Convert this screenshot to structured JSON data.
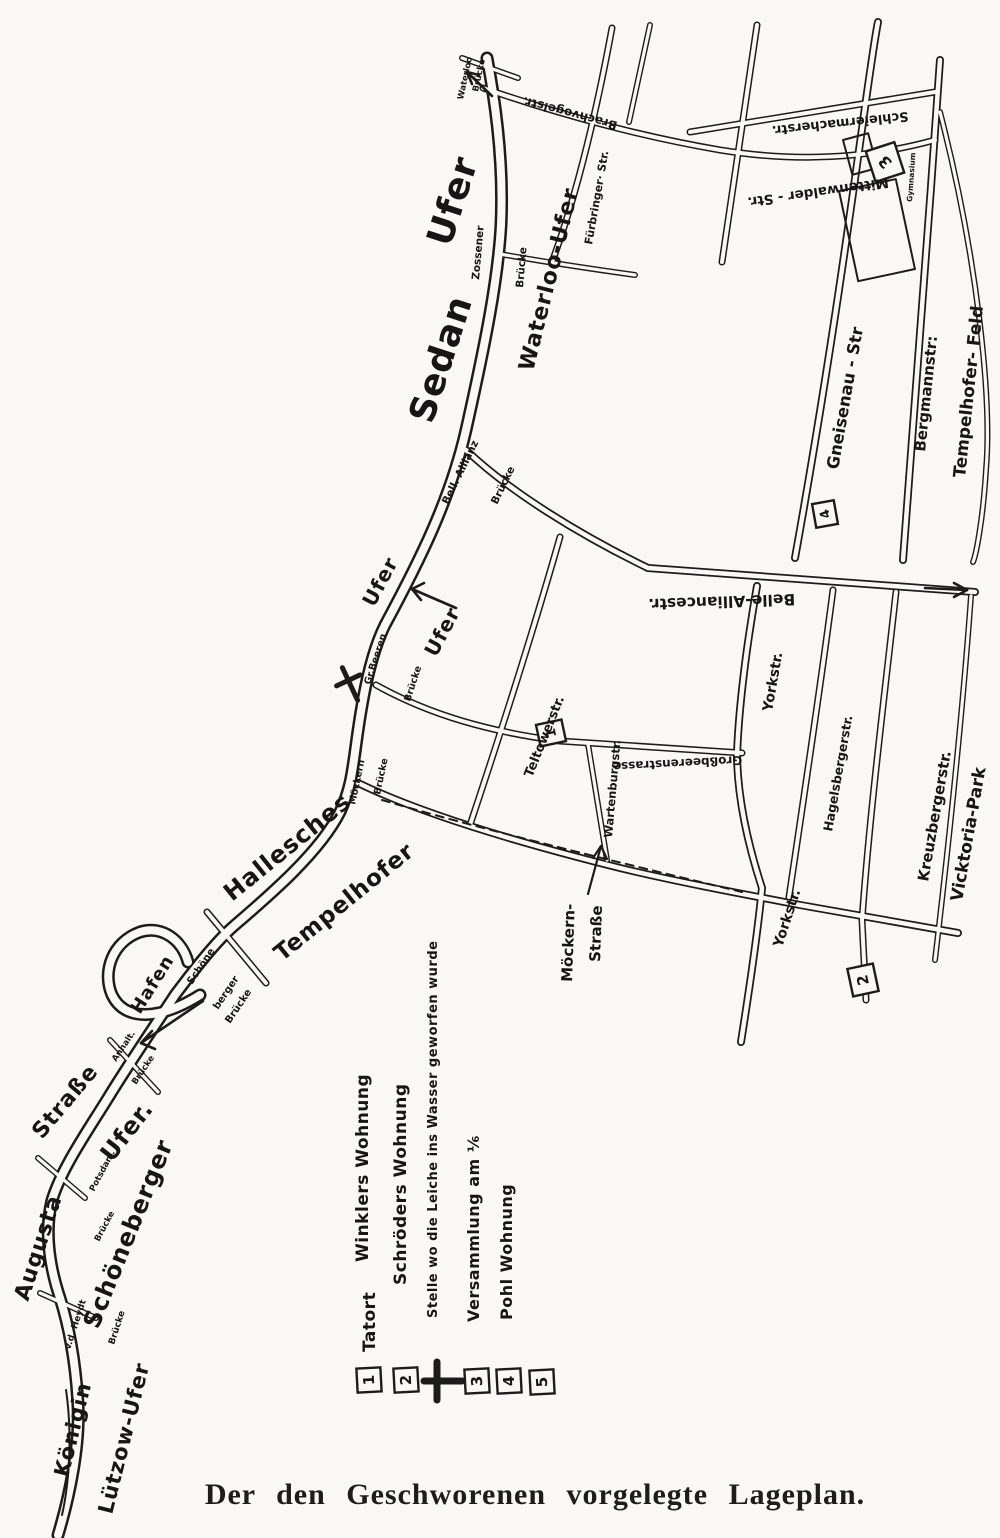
{
  "caption": {
    "text": "Der den Geschworenen vorgelegte Lageplan."
  },
  "legend": {
    "items": [
      {
        "symbol": "numbered-box",
        "number": "1",
        "label": "Tatort Winklers Wohnung",
        "label_line1": "Tatort",
        "label_line2": "Winklers Wohnung"
      },
      {
        "symbol": "numbered-box",
        "number": "2",
        "label": "Schröders Wohnung"
      },
      {
        "symbol": "cross",
        "label": "Stelle wo die Leiche ins Wasser geworfen wurde"
      },
      {
        "symbol": "numbered-box",
        "number": "3",
        "label": "Versammlung am ⅙"
      },
      {
        "symbol": "numbered-box",
        "number": "4",
        "label": "Pohl Wohnung"
      },
      {
        "symbol": "numbered-box",
        "number": "5",
        "label": ""
      }
    ]
  },
  "map": {
    "markers": {
      "m1": "1",
      "m2": "2",
      "m3": "3",
      "m4": "4"
    },
    "labels": {
      "sedan": "Sedan",
      "ufer_top": "Ufer",
      "waterloo_ufer": "Waterloo-Ufer",
      "ufer_bend_left": "Ufer",
      "ufer_bend_right": "Ufer",
      "hallesches": "Hallesches",
      "tempelhofer": "Tempelhofer",
      "hafen": "Hafen",
      "schoeneberger_big": "Schöneberger",
      "schoeneberger_ufer_word": "Ufer.",
      "strasse_big": "Straße",
      "augusta": "Augusta",
      "koenigin": "Königin",
      "luetzow_ufer": "Lützow-Ufer",
      "waterloo_br_1": "Waterloo",
      "waterloo_br_2": "Brücke",
      "zossener": "Zossener",
      "zossener_br": "Brücke",
      "brachvogelstr": "Brachvogelstr.",
      "fuerbringer_str": "Fürbringer· Str.",
      "schleiermacherstr": "Schleiermacherstr.",
      "mittenwalder_str": "Mittenwalder - Str.",
      "gymnasium": "Gymnasium",
      "gneisenau_str": "Gneisenau - Str",
      "bergmannstr": "Bergmannstr:",
      "tempelhofer_feld": "Tempelhofer- Feld",
      "bell_allianz": "Bell. Allianz",
      "bell_allianz_br": "Brücke",
      "belle_alliancestr": "Belle-Alliancestr.",
      "gr_beeren": "Gr.Beeren",
      "gr_beeren_br": "Brücke",
      "teltowerstr": "Teltowerstr.",
      "grossbeerenstrasse": "Großbeerenstrasse",
      "wartenburgstr": "Wartenburgstr.",
      "moeckern_br_1": "Möckern",
      "moeckern_br_2": "Brücke",
      "yorkstr_upper": "Yorkstr.",
      "yorkstr_lower": "Yorkstr.",
      "hagelsbergerstr": "Hagelsbergerstr.",
      "kreuzbergerstr": "Kreuzbergerstr.",
      "vicktoria_park": "Vicktoria-Park",
      "moeckernstrasse_1": "Möckern-",
      "moeckernstrasse_2": "Straße",
      "schoene": "Schöne",
      "berger": "berger",
      "schoeneberger_br": "Brücke",
      "anhalt": "Anhalt.",
      "anhalt_br": "Brücke",
      "potsdam": "Potsdam.",
      "potsdam_br": "Brücke",
      "vdheydt": "v.d. Heydt",
      "vdheydt_br": "Brücke"
    }
  }
}
